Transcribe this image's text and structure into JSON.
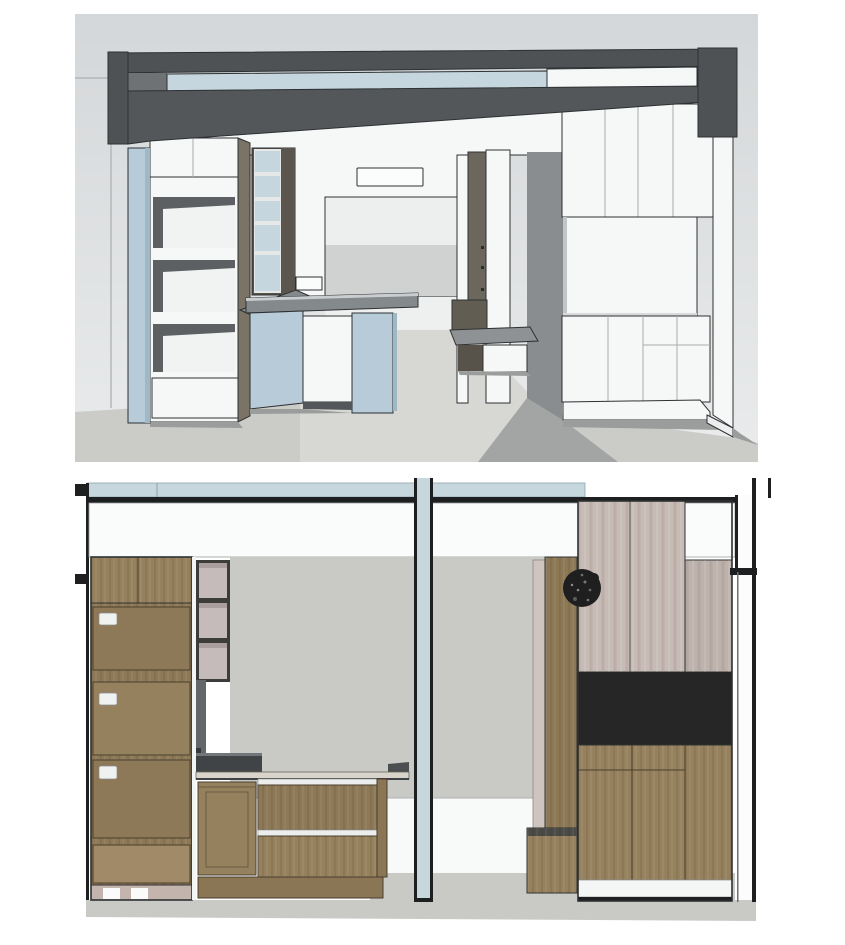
{
  "page": {
    "background": "#ffffff"
  },
  "figure": {
    "views": [
      {
        "id": "top-view",
        "type": "3d-perspective-interior-rendering",
        "elements": [
          "ceiling-beam",
          "clerestory-glass-strip",
          "left-pillar",
          "open-shelf-tower",
          "glass-door-upper-cabinet",
          "kitchen-island",
          "sink",
          "window-panel",
          "ceiling-light",
          "tv-partition",
          "storage-bench",
          "tall-wardrobe",
          "floor"
        ]
      },
      {
        "id": "bottom-view",
        "type": "interior-elevation-rendering",
        "elements": [
          "ceiling-band",
          "beam-line",
          "tall-drawer-cabinet",
          "upper-display-boxes",
          "counter-cabinet",
          "cooktop-slab",
          "structural-post",
          "wall",
          "wood-partition",
          "bench-cabinet",
          "wreath",
          "tall-wardrobe",
          "black-niche",
          "base-cabinet",
          "wall-section-frame",
          "floor"
        ]
      }
    ]
  },
  "colors": {
    "line": "#2e3133",
    "beamDark": "#4e5254",
    "beamMid": "#6e7274",
    "glassBlue": "#c5d6de",
    "cabWhite": "#f6f7f7",
    "wallTop": "#d4d7d9",
    "wallBottom": "#e9ebec",
    "floorGray": "#cbccc8",
    "floorLight": "#d7d8d4",
    "shadowWall": "#8a8d8f",
    "shadowFloor": "#9a9d9b",
    "windowTop": "#edefef",
    "windowBottom": "#cfd2d0",
    "towerSide": "#7b7466",
    "partitionOlive": "#6b675c",
    "counterGray": "#84898b",
    "counterEdge": "#c9cdcf",
    "islandBlue": "#b7ccd8",
    "islandBlueDark": "#9fb8c6",
    "benchTop": "#8e9294",
    "elevBlue": "#c6d7de",
    "black": "#1d1f20",
    "woodA": "#96815e",
    "woodB": "#8d7857",
    "woodC": "#a18a68",
    "woodKick": "#8a7554",
    "mauve": "#c6bbbb",
    "basePink": "#c3b4ae",
    "taupe": "#c6bbb5",
    "taupePanel": "#bdb2ac",
    "niche": "#262626",
    "applianceDark": "#404446",
    "wallGrayElev": "#c9cac6",
    "counterTopLight": "#d9d4cb",
    "handleWhite": "#f0f1f1",
    "soffitWhite": "#fafbfb",
    "partitionWood": "#8d7856",
    "lightPanel": "#cfc5c0",
    "darkFrame": "#3c3c3a"
  }
}
